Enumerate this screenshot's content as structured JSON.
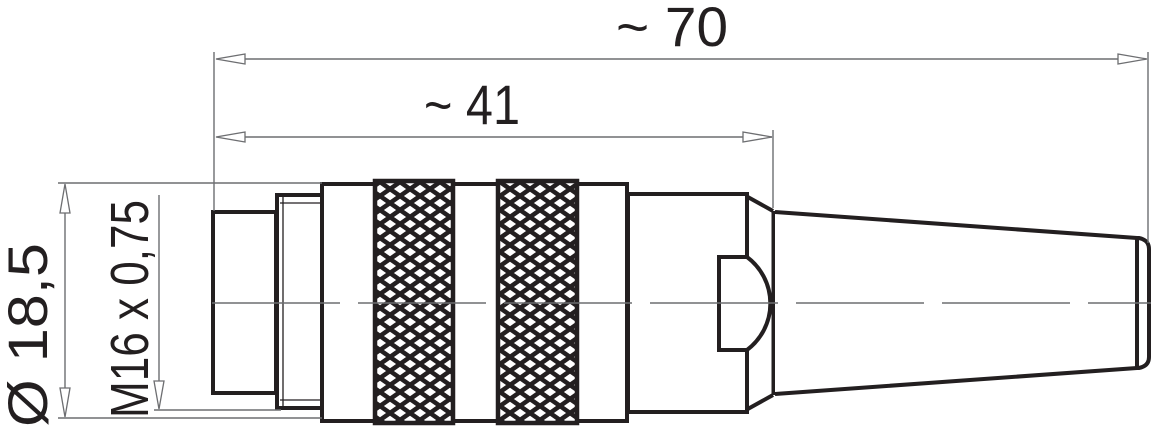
{
  "drawing": {
    "type": "technical-dimension-drawing",
    "subject": "cable-connector-side-view",
    "dimensions": {
      "overall_length": "~ 70",
      "front_length": "~ 41",
      "grip_diameter": "Ø 18,5",
      "thread": "M16 x 0,75"
    },
    "colors": {
      "outline": "#231f20",
      "dimension_lines": "#6d6e71",
      "background": "#ffffff"
    }
  }
}
